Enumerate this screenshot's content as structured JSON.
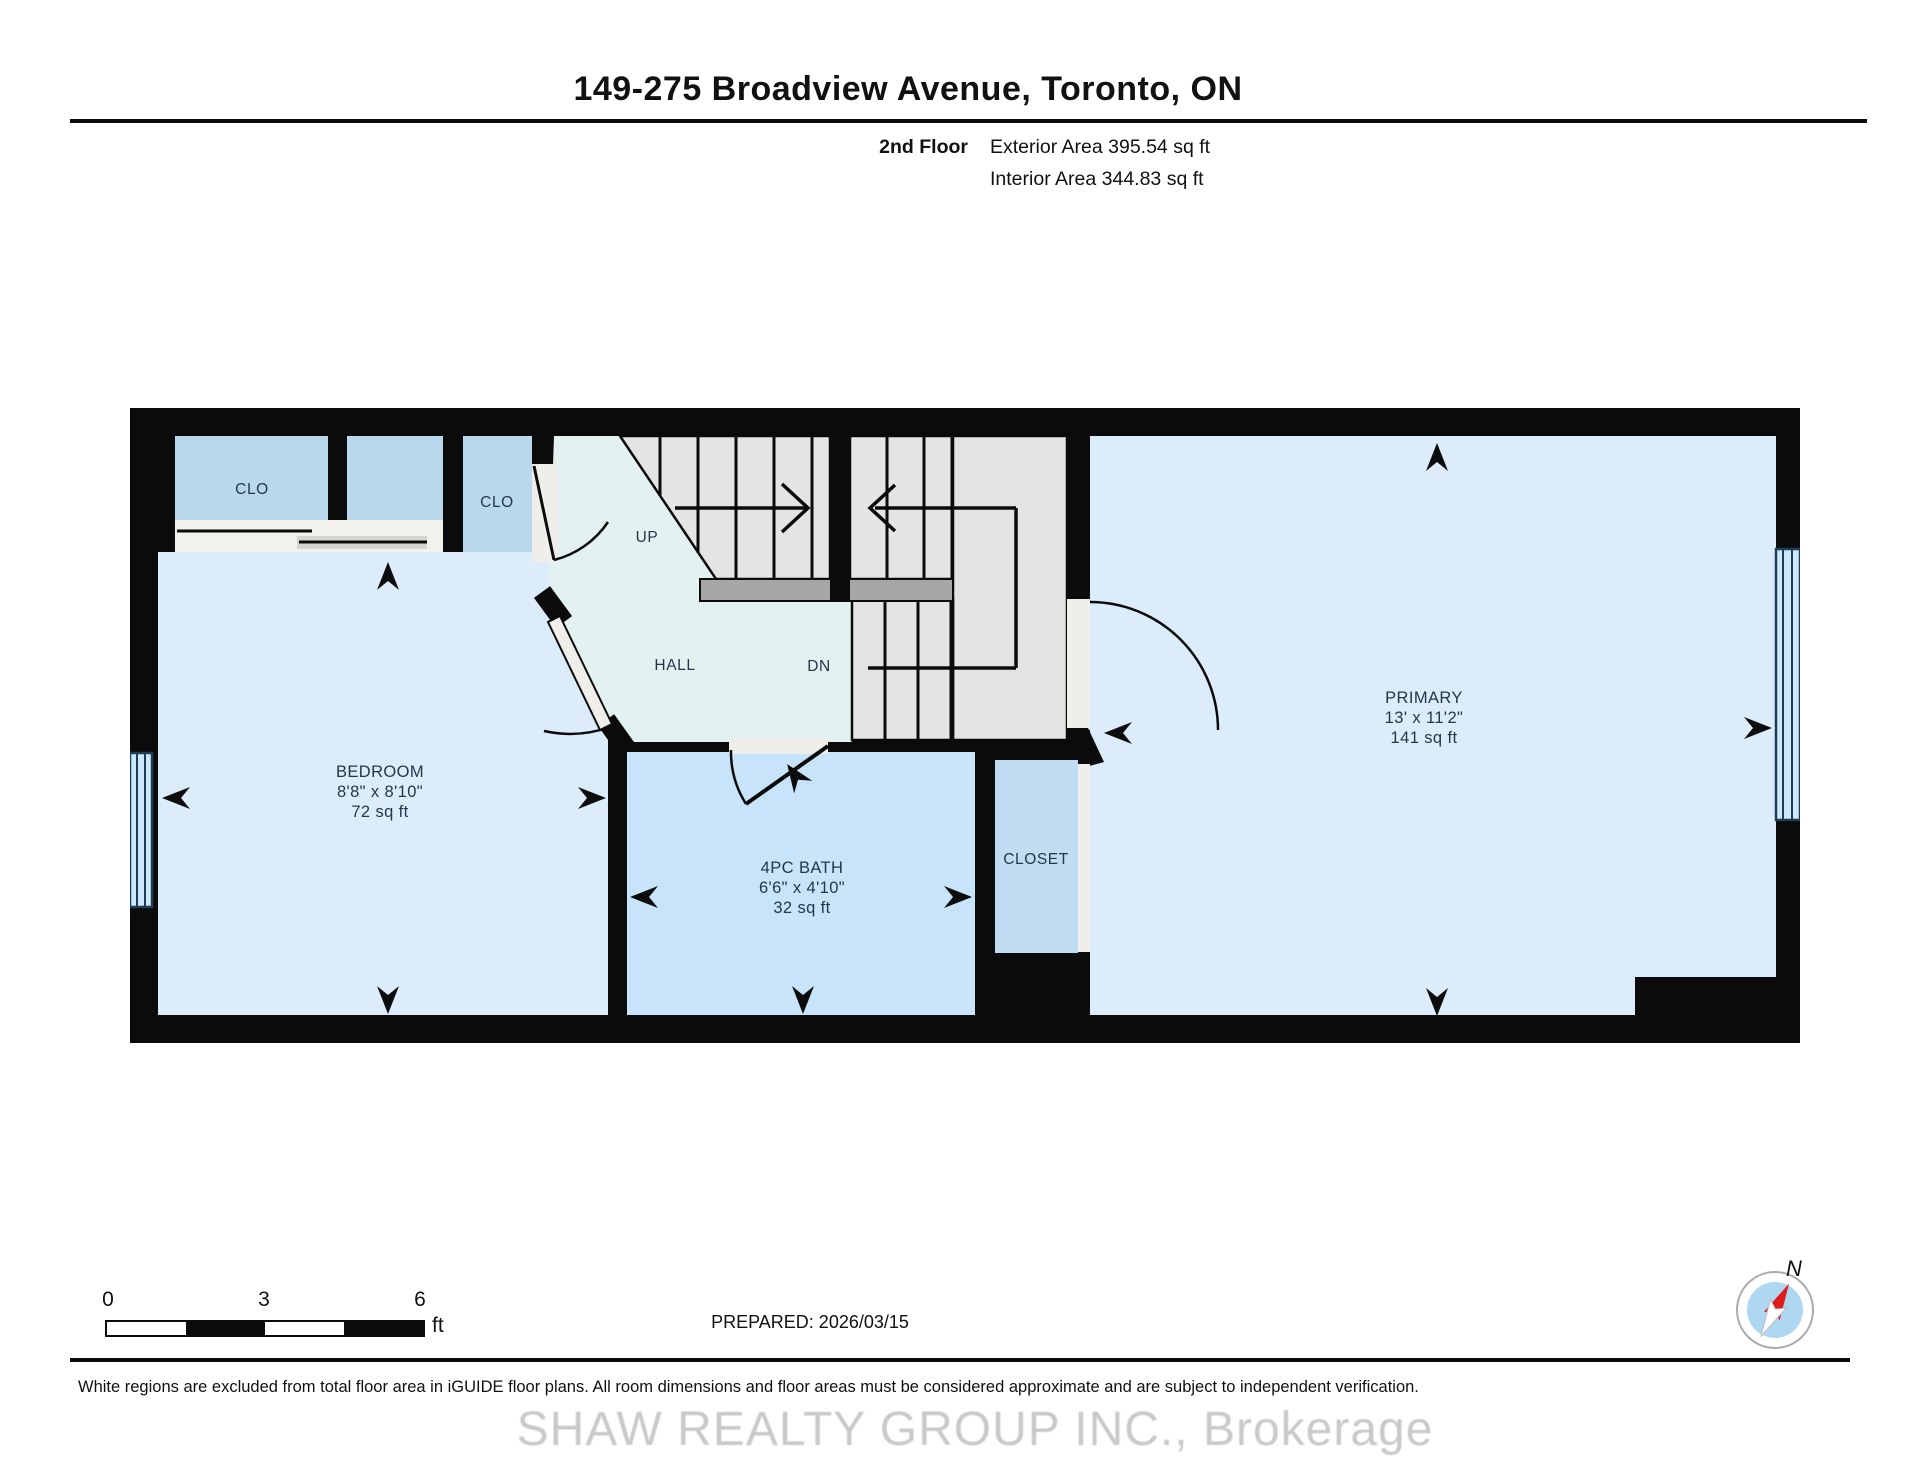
{
  "header": {
    "title": "149-275 Broadview Avenue, Toronto, ON",
    "floor_label": "2nd Floor",
    "exterior_area": "Exterior Area 395.54 sq ft",
    "interior_area": "Interior Area 344.83 sq ft"
  },
  "rooms": {
    "bedroom": {
      "name": "BEDROOM",
      "dims": "8'8\" x 8'10\"",
      "area": "72 sq ft"
    },
    "bath": {
      "name": "4PC BATH",
      "dims": "6'6\" x 4'10\"",
      "area": "32 sq ft"
    },
    "primary": {
      "name": "PRIMARY",
      "dims": "13' x 11'2\"",
      "area": "141 sq ft"
    },
    "closet": {
      "name": "CLOSET"
    },
    "closet_left": {
      "name": "CLO"
    },
    "closet_hall": {
      "name": "CLO"
    },
    "hall": {
      "name": "HALL"
    }
  },
  "stairs": {
    "up_label": "UP",
    "down_label": "DN"
  },
  "scale_bar": {
    "tick_0": "0",
    "tick_3": "3",
    "tick_6": "6",
    "unit": "ft"
  },
  "compass": {
    "north_label": "N"
  },
  "footer": {
    "prepared": "PREPARED: 2026/03/15",
    "disclaimer": "White regions are excluded from total floor area in iGUIDE floor plans. All room dimensions and floor areas must be considered approximate and are subject to independent verification.",
    "watermark": "SHAW REALTY GROUP INC., Brokerage"
  },
  "colors": {
    "wall": "#0b0b0b",
    "room_light_blue": "#dcecfb",
    "bath_blue": "#c7e4fa",
    "closet_blue": "#b9d8ee",
    "hall_mint": "#e3f2f0",
    "stairs_gray": "#e4e4e4",
    "railing_gray": "#a6a6a6",
    "window_blue": "#cde8fc",
    "label_text": "#22384a"
  }
}
